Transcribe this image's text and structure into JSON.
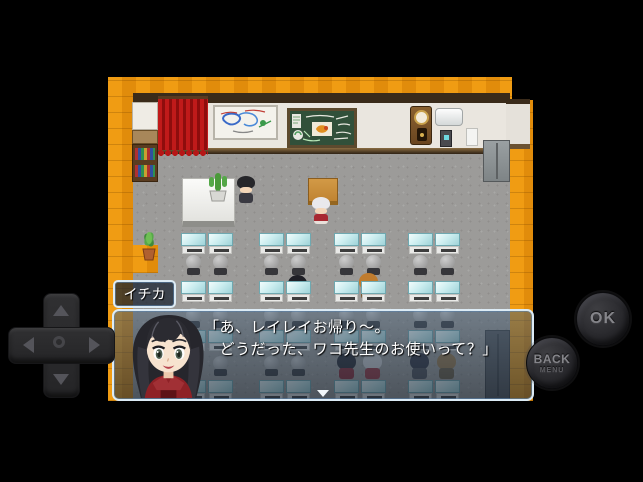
{
  "colors": {
    "floor_wood": "#e8910e",
    "room_floor": "#9c9b99",
    "wall_white": "#eae6df",
    "curtain_red": "#b41a1a",
    "chalkboard_green": "#31503a",
    "desk_glass": "#cdeef0",
    "dialog_border": "#dcebf5",
    "button_text": "#85858a"
  },
  "game": {
    "dialogue": {
      "speaker": "イチカ",
      "lines": [
        "「あ、レイレイお帰り〜。",
        "　どうだった、ワコ先生のお使いって？」"
      ]
    },
    "map": {
      "desk_xs": [
        73,
        100,
        151,
        178,
        226,
        253,
        300,
        327
      ],
      "chair_xs": [
        77,
        104,
        155,
        182,
        230,
        257,
        304,
        331
      ],
      "desk_rows_y": [
        156,
        204,
        253,
        303
      ],
      "chair_rows_y": [
        178,
        231,
        279
      ],
      "students": [
        {
          "x": 179,
          "y": 198,
          "hair": "#1f1f26",
          "body": "#7a2028"
        },
        {
          "x": 250,
          "y": 196,
          "hair": "#c07c2e",
          "body": "#7a5a32"
        },
        {
          "x": 228,
          "y": 276,
          "hair": "#23232b",
          "body": "#8a2430"
        },
        {
          "x": 254,
          "y": 276,
          "hair": "#cfcfd2",
          "body": "#99303a"
        },
        {
          "x": 301,
          "y": 276,
          "hair": "#2e2e3c",
          "body": "#4a4a52"
        },
        {
          "x": 328,
          "y": 276,
          "hair": "#9a7848",
          "body": "#6a5a40"
        }
      ]
    }
  },
  "controls": {
    "ok_label": "OK",
    "back_label": "BACK",
    "back_sub_label": "MENU"
  },
  "icons": {
    "dpad_up": "triangle-up",
    "dpad_down": "triangle-down",
    "dpad_left": "triangle-left",
    "dpad_right": "triangle-right",
    "continue_indicator": "triangle-down"
  }
}
